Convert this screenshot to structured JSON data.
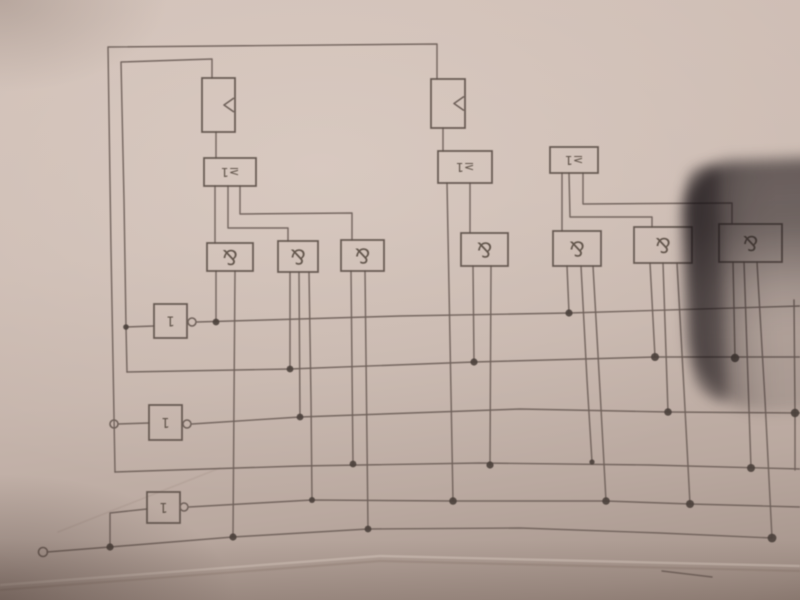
{
  "photo": {
    "subject": "hand-drawn logic circuit sketch on paper, photographed upside-down",
    "paper_color": "#c9b8af",
    "pencil_color": "#6e6059",
    "box_color": "#5f524b",
    "dot_color": "#4a403b",
    "label_color": "#564a40",
    "shadow_color": "rgba(24,18,21,0.5)",
    "label_rotation_deg": 180,
    "creases": [
      {
        "name": "bottom-paper-curl-light",
        "points": [
          [
            0,
            585
          ],
          [
            380,
            556
          ],
          [
            800,
            566
          ]
        ],
        "color": "rgba(235,221,210,0.38)",
        "width": 2.4
      },
      {
        "name": "bottom-paper-curl-dark",
        "points": [
          [
            0,
            590
          ],
          [
            380,
            561
          ],
          [
            800,
            571
          ]
        ],
        "color": "rgba(90,70,60,0.14)",
        "width": 2.2
      },
      {
        "name": "faint-diagonal-crease",
        "points": [
          [
            58,
            532
          ],
          [
            220,
            468
          ]
        ],
        "color": "rgba(110,88,78,0.10)",
        "width": 1.6
      }
    ]
  },
  "diagram": {
    "gates": [
      {
        "id": "flipflop-1",
        "type": "ff",
        "label": "<",
        "clock": true,
        "x": 202,
        "y": 78,
        "w": 33,
        "h": 54
      },
      {
        "id": "flipflop-2",
        "type": "ff",
        "label": "<",
        "clock": true,
        "x": 431,
        "y": 79,
        "w": 34,
        "h": 49
      },
      {
        "id": "or-1",
        "type": "or",
        "label": "≥1",
        "x": 204,
        "y": 158,
        "w": 52,
        "h": 28
      },
      {
        "id": "or-2",
        "type": "or",
        "label": "≥1",
        "x": 438,
        "y": 151,
        "w": 54,
        "h": 32
      },
      {
        "id": "or-3",
        "type": "or",
        "label": "≥1",
        "x": 550,
        "y": 147,
        "w": 48,
        "h": 26
      },
      {
        "id": "and-1",
        "type": "and",
        "label": "&",
        "x": 207,
        "y": 243,
        "w": 46,
        "h": 28
      },
      {
        "id": "and-2",
        "type": "and",
        "label": "&",
        "x": 278,
        "y": 241,
        "w": 40,
        "h": 31
      },
      {
        "id": "and-3",
        "type": "and",
        "label": "&",
        "x": 341,
        "y": 240,
        "w": 43,
        "h": 31
      },
      {
        "id": "and-4",
        "type": "and",
        "label": "&",
        "x": 461,
        "y": 233,
        "w": 47,
        "h": 33
      },
      {
        "id": "and-5",
        "type": "and",
        "label": "&",
        "x": 553,
        "y": 231,
        "w": 48,
        "h": 35
      },
      {
        "id": "and-6",
        "type": "and",
        "label": "&",
        "x": 634,
        "y": 227,
        "w": 58,
        "h": 36
      },
      {
        "id": "and-7",
        "type": "and",
        "label": "&",
        "x": 719,
        "y": 224,
        "w": 63,
        "h": 38
      },
      {
        "id": "not-1",
        "type": "not",
        "label": "1",
        "x": 154,
        "y": 304,
        "w": 33,
        "h": 34
      },
      {
        "id": "not-2",
        "type": "not",
        "label": "1",
        "x": 149,
        "y": 405,
        "w": 33,
        "h": 35
      },
      {
        "id": "not-3",
        "type": "not",
        "label": "1",
        "x": 147,
        "y": 492,
        "w": 33,
        "h": 31
      }
    ],
    "wires": [
      {
        "name": "feedback-outer-top",
        "points": [
          [
            437,
            79
          ],
          [
            437,
            44
          ],
          [
            108,
            47
          ],
          [
            111,
            250
          ],
          [
            115,
            472
          ]
        ]
      },
      {
        "name": "bus-row4",
        "points": [
          [
            115,
            472
          ],
          [
            300,
            466
          ],
          [
            480,
            463
          ],
          [
            650,
            465
          ],
          [
            800,
            469
          ]
        ]
      },
      {
        "name": "feedback-inner-top",
        "points": [
          [
            212,
            78
          ],
          [
            212,
            59
          ],
          [
            121,
            62
          ],
          [
            124,
            200
          ],
          [
            126,
            327
          ],
          [
            127,
            372
          ]
        ]
      },
      {
        "name": "bus-row2",
        "points": [
          [
            127,
            372
          ],
          [
            290,
            369
          ],
          [
            474,
            362
          ],
          [
            655,
            357
          ],
          [
            800,
            357
          ]
        ]
      },
      {
        "name": "bus-row1",
        "points": [
          [
            197,
            322
          ],
          [
            400,
            316
          ],
          [
            569,
            313
          ],
          [
            800,
            306
          ]
        ]
      },
      {
        "name": "bus-row3",
        "points": [
          [
            192,
            424
          ],
          [
            300,
            417
          ],
          [
            520,
            409
          ],
          [
            668,
            412
          ],
          [
            800,
            413
          ]
        ]
      },
      {
        "name": "bus-row5",
        "points": [
          [
            189,
            507
          ],
          [
            312,
            500
          ],
          [
            453,
            501
          ],
          [
            606,
            501
          ],
          [
            690,
            504
          ],
          [
            800,
            507
          ]
        ]
      },
      {
        "name": "bus-row6",
        "points": [
          [
            47,
            552
          ],
          [
            110,
            547
          ],
          [
            233,
            537
          ],
          [
            368,
            529
          ],
          [
            520,
            528
          ],
          [
            660,
            533
          ],
          [
            772,
            538
          ]
        ]
      },
      {
        "name": "ff1-to-or1",
        "points": [
          [
            216,
            132
          ],
          [
            216,
            158
          ]
        ]
      },
      {
        "name": "ff2-to-or2",
        "points": [
          [
            443,
            128
          ],
          [
            443,
            151
          ]
        ]
      },
      {
        "name": "or1-to-and1",
        "points": [
          [
            215,
            186
          ],
          [
            215,
            243
          ]
        ]
      },
      {
        "name": "or1-to-and2",
        "points": [
          [
            228,
            186
          ],
          [
            228,
            228
          ],
          [
            288,
            228
          ],
          [
            288,
            241
          ]
        ]
      },
      {
        "name": "or1-to-and3",
        "points": [
          [
            240,
            186
          ],
          [
            240,
            214
          ],
          [
            352,
            213
          ],
          [
            352,
            240
          ]
        ]
      },
      {
        "name": "or2-to-row5",
        "points": [
          [
            447,
            183
          ],
          [
            450,
            340
          ],
          [
            453,
            501
          ]
        ]
      },
      {
        "name": "or2-to-and4",
        "points": [
          [
            470,
            183
          ],
          [
            470,
            233
          ]
        ]
      },
      {
        "name": "or3-to-and5",
        "points": [
          [
            562,
            173
          ],
          [
            562,
            231
          ]
        ]
      },
      {
        "name": "or3-to-and6",
        "points": [
          [
            569,
            173
          ],
          [
            570,
            217
          ],
          [
            652,
            217
          ],
          [
            652,
            227
          ]
        ]
      },
      {
        "name": "or3-to-and7",
        "points": [
          [
            583,
            173
          ],
          [
            583,
            204
          ],
          [
            732,
            203
          ],
          [
            732,
            224
          ]
        ]
      },
      {
        "name": "and1-drop-row1",
        "points": [
          [
            216,
            271
          ],
          [
            216,
            322
          ]
        ]
      },
      {
        "name": "and1-drop-row6",
        "points": [
          [
            235,
            271
          ],
          [
            234,
            400
          ],
          [
            233,
            537
          ]
        ]
      },
      {
        "name": "and2-drop-row2",
        "points": [
          [
            290,
            272
          ],
          [
            290,
            369
          ]
        ]
      },
      {
        "name": "and2-drop-row3",
        "points": [
          [
            299,
            272
          ],
          [
            300,
            417
          ]
        ]
      },
      {
        "name": "and2-drop-row5",
        "points": [
          [
            309,
            272
          ],
          [
            311,
            400
          ],
          [
            312,
            500
          ]
        ]
      },
      {
        "name": "and3-drop-row4",
        "points": [
          [
            351,
            271
          ],
          [
            353,
            464
          ]
        ]
      },
      {
        "name": "and3-drop-row6",
        "points": [
          [
            365,
            271
          ],
          [
            368,
            529
          ]
        ]
      },
      {
        "name": "and4-drop-row2",
        "points": [
          [
            473,
            266
          ],
          [
            474,
            362
          ]
        ]
      },
      {
        "name": "and4-drop-row4",
        "points": [
          [
            491,
            266
          ],
          [
            490,
            465
          ]
        ]
      },
      {
        "name": "and5-drop-row1",
        "points": [
          [
            567,
            266
          ],
          [
            569,
            313
          ]
        ]
      },
      {
        "name": "and5-drop-row4",
        "points": [
          [
            581,
            266
          ],
          [
            587,
            380
          ],
          [
            592,
            462
          ]
        ]
      },
      {
        "name": "and5-drop-row5",
        "points": [
          [
            593,
            266
          ],
          [
            600,
            390
          ],
          [
            606,
            501
          ]
        ]
      },
      {
        "name": "and6-drop-row2",
        "points": [
          [
            650,
            263
          ],
          [
            655,
            357
          ]
        ]
      },
      {
        "name": "and6-drop-row3",
        "points": [
          [
            663,
            263
          ],
          [
            668,
            412
          ]
        ]
      },
      {
        "name": "and6-drop-row5",
        "points": [
          [
            677,
            263
          ],
          [
            684,
            390
          ],
          [
            690,
            504
          ]
        ]
      },
      {
        "name": "and7-drop-row2",
        "points": [
          [
            733,
            262
          ],
          [
            735,
            358
          ]
        ]
      },
      {
        "name": "and7-drop-row4",
        "points": [
          [
            744,
            262
          ],
          [
            751,
            468
          ]
        ]
      },
      {
        "name": "and7-drop-row6",
        "points": [
          [
            757,
            262
          ],
          [
            765,
            400
          ],
          [
            772,
            538
          ]
        ]
      },
      {
        "name": "not1-input",
        "points": [
          [
            126,
            327
          ],
          [
            154,
            326
          ]
        ]
      },
      {
        "name": "not2-input",
        "points": [
          [
            118,
            424
          ],
          [
            149,
            423
          ]
        ]
      },
      {
        "name": "not3-input",
        "points": [
          [
            110,
            547
          ],
          [
            110,
            513
          ],
          [
            147,
            509
          ]
        ]
      },
      {
        "name": "right-edge-stub",
        "points": [
          [
            794,
            300
          ],
          [
            795,
            413
          ],
          [
            795,
            470
          ]
        ]
      },
      {
        "name": "stray-pencil-mark",
        "points": [
          [
            662,
            571
          ],
          [
            712,
            577
          ]
        ]
      }
    ],
    "junctions": [
      [
        126,
        327,
        2.8
      ],
      [
        216,
        322,
        3.4
      ],
      [
        290,
        369,
        3.4
      ],
      [
        300,
        417,
        3.4
      ],
      [
        312,
        500,
        3.0
      ],
      [
        353,
        464,
        3.4
      ],
      [
        368,
        529,
        3.4
      ],
      [
        453,
        501,
        3.8
      ],
      [
        474,
        362,
        3.6
      ],
      [
        490,
        465,
        3.6
      ],
      [
        569,
        313,
        3.6
      ],
      [
        592,
        462,
        2.6
      ],
      [
        606,
        501,
        3.8
      ],
      [
        655,
        357,
        4.0
      ],
      [
        668,
        412,
        3.8
      ],
      [
        690,
        504,
        4.0
      ],
      [
        735,
        358,
        4.2
      ],
      [
        751,
        468,
        4.0
      ],
      [
        772,
        538,
        4.4
      ],
      [
        795,
        413,
        4.2
      ],
      [
        110,
        547,
        3.6
      ],
      [
        233,
        537,
        3.6
      ]
    ],
    "terminals": [
      [
        43,
        552,
        4.5
      ],
      [
        114,
        424,
        4.0
      ]
    ],
    "inverter_bubbles": [
      [
        192,
        322,
        4.0
      ],
      [
        187,
        424,
        4.0
      ],
      [
        184,
        507,
        4.0
      ]
    ]
  }
}
